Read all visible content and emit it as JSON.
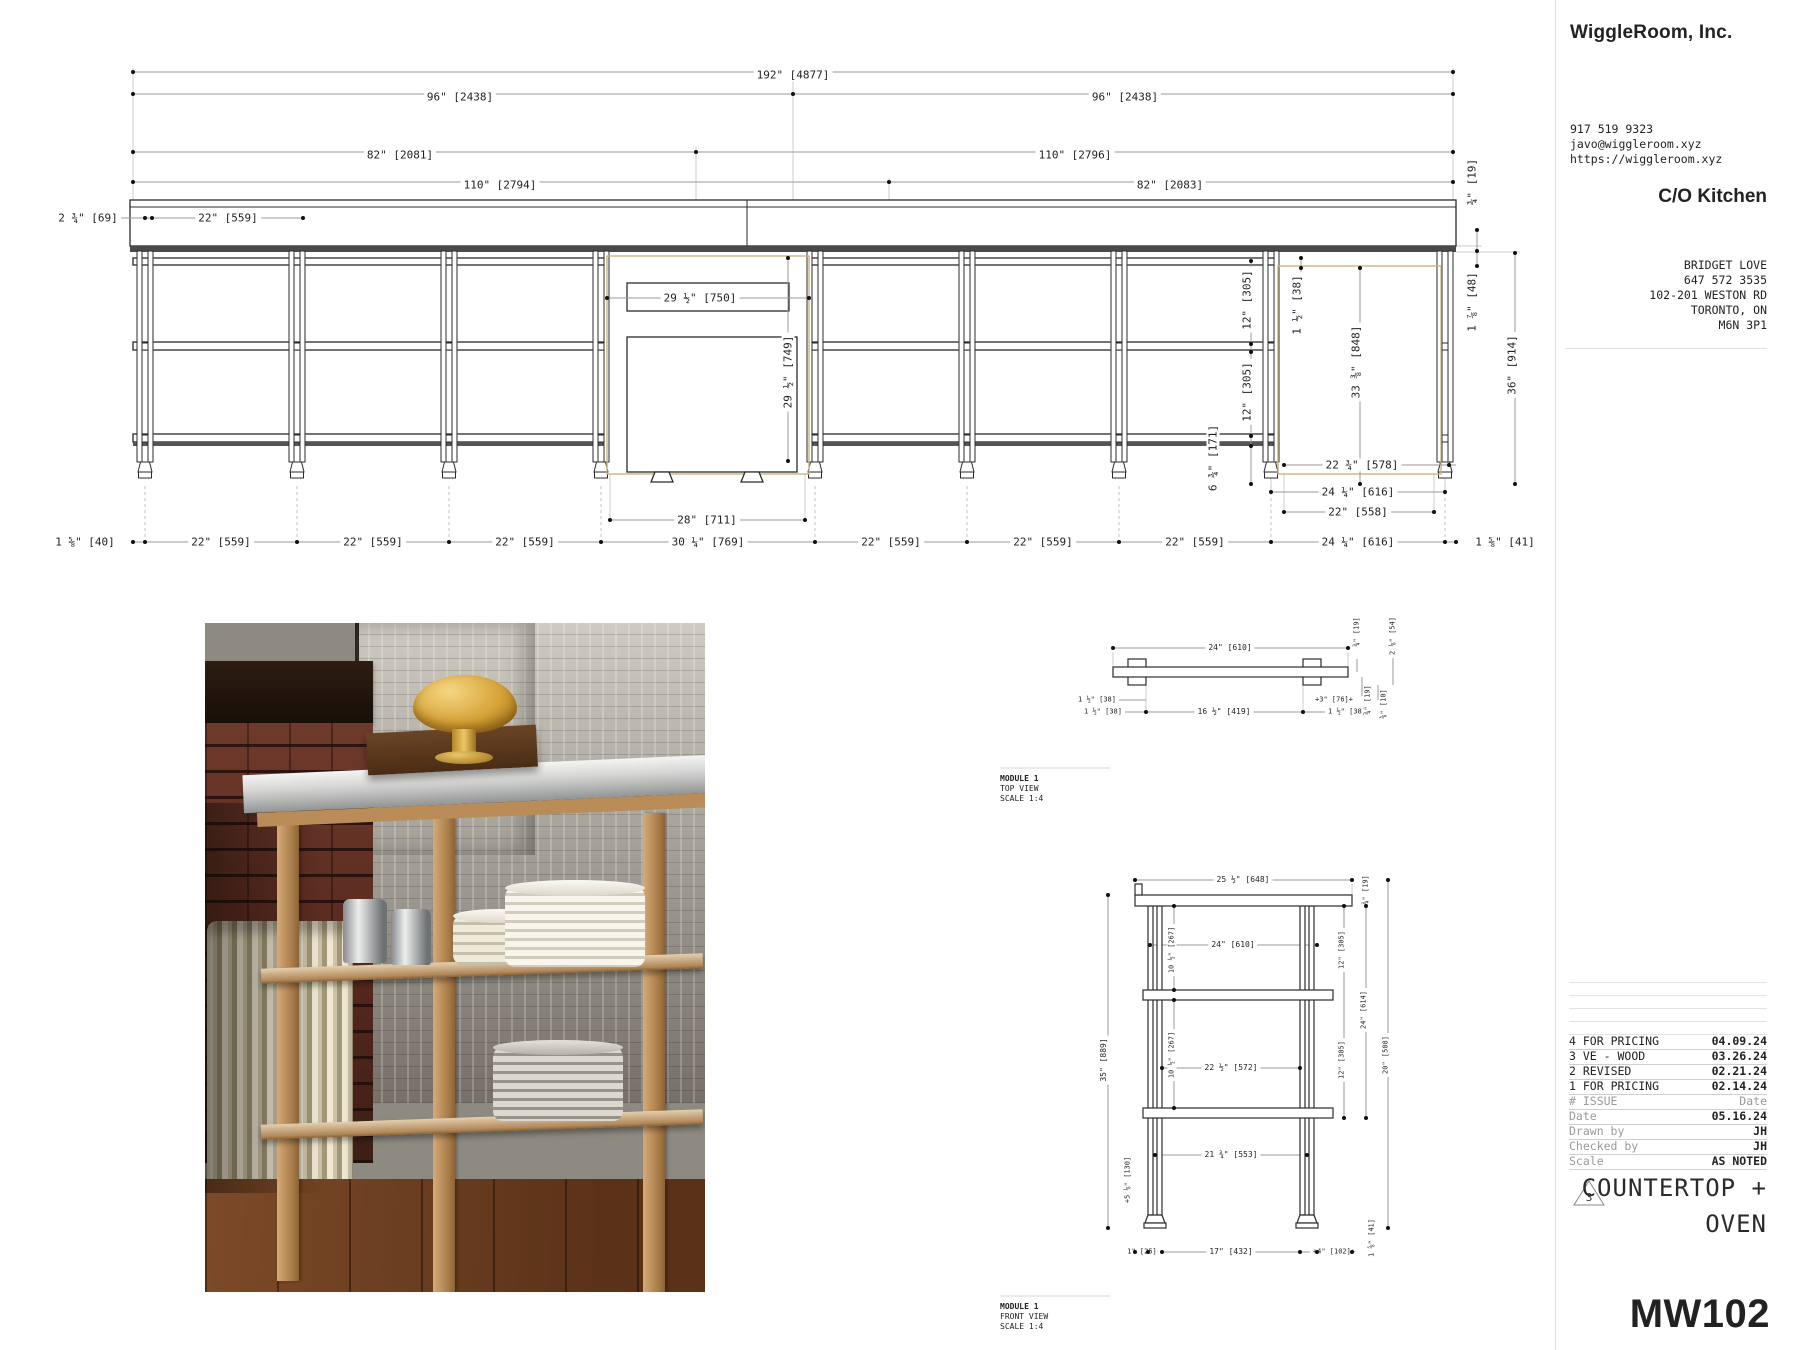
{
  "sheet": {
    "company": "WiggleRoom, Inc.",
    "contact": {
      "phone": "917 519 9323",
      "email": "javo@wiggleroom.xyz",
      "website": "https://wiggleroom.xyz"
    },
    "project": "C/O Kitchen",
    "client": {
      "name": "BRIDGET LOVE",
      "phone": "647 572 3535",
      "address": "102-201 WESTON RD",
      "city": "TORONTO, ON",
      "postal": "M6N 3P1"
    },
    "revisions": [
      {
        "num": "4",
        "label": "FOR PRICING",
        "date": "04.09.24"
      },
      {
        "num": "3",
        "label": "VE - WOOD",
        "date": "03.26.24"
      },
      {
        "num": "2",
        "label": "REVISED",
        "date": "02.21.24"
      },
      {
        "num": "1",
        "label": "FOR PRICING",
        "date": "02.14.24"
      }
    ],
    "issue": {
      "label": "# ISSUE",
      "value": "Date"
    },
    "meta": [
      {
        "label": "Date",
        "value": "05.16.24"
      },
      {
        "label": "Drawn by",
        "value": "JH"
      },
      {
        "label": "Checked by",
        "value": "JH"
      },
      {
        "label": "Scale",
        "value": "AS NOTED"
      }
    ],
    "badge": "3",
    "title_line1": "COUNTERTOP +",
    "title_line2": "OVEN",
    "code": "MW102"
  },
  "drawing": {
    "labels": [
      {
        "t": "192\" [4877]",
        "x": 793,
        "y": 75
      },
      {
        "t": "96\" [2438]",
        "x": 460,
        "y": 97
      },
      {
        "t": "96\" [2438]",
        "x": 1125,
        "y": 97
      },
      {
        "t": "82\" [2081]",
        "x": 400,
        "y": 155
      },
      {
        "t": "110\" [2796]",
        "x": 1075,
        "y": 155
      },
      {
        "t": "110\" [2794]",
        "x": 500,
        "y": 185
      },
      {
        "t": "82\" [2083]",
        "x": 1170,
        "y": 185
      },
      {
        "t": "2 ¾\" [69]",
        "x": 88,
        "y": 218
      },
      {
        "t": "22\" [559]",
        "x": 228,
        "y": 218
      },
      {
        "t": "29 ½\" [750]",
        "x": 700,
        "y": 298
      },
      {
        "t": "29 ½\" [749]",
        "x": 788,
        "y": 372,
        "r": 1
      },
      {
        "t": "28\" [711]",
        "x": 707,
        "y": 520
      },
      {
        "t": "12\" [305]",
        "x": 1247,
        "y": 300,
        "r": 1
      },
      {
        "t": "12\" [305]",
        "x": 1247,
        "y": 392,
        "r": 1
      },
      {
        "t": "6 ¾\" [171]",
        "x": 1213,
        "y": 458,
        "r": 1
      },
      {
        "t": "1 ½\" [38]",
        "x": 1297,
        "y": 305,
        "r": 1
      },
      {
        "t": "33 ⅜\" [848]",
        "x": 1356,
        "y": 362,
        "r": 1
      },
      {
        "t": "¾\" [19]",
        "x": 1472,
        "y": 182,
        "r": 1
      },
      {
        "t": "1 ⅞\" [48]",
        "x": 1472,
        "y": 302,
        "r": 1
      },
      {
        "t": "36\" [914]",
        "x": 1512,
        "y": 365,
        "r": 1
      },
      {
        "t": "22 ¾\" [578]",
        "x": 1362,
        "y": 465
      },
      {
        "t": "24 ¼\" [616]",
        "x": 1358,
        "y": 492
      },
      {
        "t": "22\" [558]",
        "x": 1358,
        "y": 512
      },
      {
        "t": "1 ⅝\" [40]",
        "x": 85,
        "y": 542
      },
      {
        "t": "22\" [559]",
        "x": 221,
        "y": 542
      },
      {
        "t": "22\" [559]",
        "x": 373,
        "y": 542
      },
      {
        "t": "22\" [559]",
        "x": 525,
        "y": 542
      },
      {
        "t": "30 ¼\" [769]",
        "x": 708,
        "y": 542
      },
      {
        "t": "22\" [559]",
        "x": 891,
        "y": 542
      },
      {
        "t": "22\" [559]",
        "x": 1043,
        "y": 542
      },
      {
        "t": "22\" [559]",
        "x": 1195,
        "y": 542
      },
      {
        "t": "24 ¼\" [616]",
        "x": 1358,
        "y": 542
      },
      {
        "t": "1 ⅝\" [41]",
        "x": 1505,
        "y": 542
      },
      {
        "t": "24\" [610]",
        "x": 1230,
        "y": 648,
        "fs": 8
      },
      {
        "t": "¾\" [19]",
        "x": 1357,
        "y": 632,
        "r": 1,
        "fs": 7
      },
      {
        "t": "2 ⅛\" [54]",
        "x": 1393,
        "y": 636,
        "r": 1,
        "fs": 7
      },
      {
        "t": "1 ½\" [38]",
        "x": 1097,
        "y": 700,
        "fs": 7
      },
      {
        "t": "1 ½\" [38]",
        "x": 1103,
        "y": 712,
        "fs": 7
      },
      {
        "t": "16 ½\" [419]",
        "x": 1224,
        "y": 712,
        "fs": 8
      },
      {
        "t": "+3\" [76]+",
        "x": 1334,
        "y": 700,
        "fs": 7
      },
      {
        "t": "1 ½\" [38]",
        "x": 1347,
        "y": 712,
        "fs": 7
      },
      {
        "t": "¾\" [19]",
        "x": 1368,
        "y": 700,
        "r": 1,
        "fs": 7
      },
      {
        "t": "⅜\" [10]",
        "x": 1384,
        "y": 704,
        "r": 1,
        "fs": 7
      },
      {
        "t": "MODULE 1",
        "x": 1000,
        "y": 779,
        "fs": 8,
        "al": "l",
        "b": 1
      },
      {
        "t": "TOP VIEW",
        "x": 1000,
        "y": 789,
        "fs": 8,
        "al": "l"
      },
      {
        "t": "SCALE 1:4",
        "x": 1000,
        "y": 799,
        "fs": 8,
        "al": "l"
      },
      {
        "t": "25 ½\" [648]",
        "x": 1243,
        "y": 880,
        "fs": 8
      },
      {
        "t": "¾\" [19]",
        "x": 1366,
        "y": 890,
        "r": 1,
        "fs": 7
      },
      {
        "t": "24\" [610]",
        "x": 1233,
        "y": 945,
        "fs": 8
      },
      {
        "t": "35\" [889]",
        "x": 1104,
        "y": 1060,
        "r": 1,
        "fs": 8
      },
      {
        "t": "10 ½\" [267]",
        "x": 1172,
        "y": 950,
        "r": 1,
        "fs": 7
      },
      {
        "t": "10 ½\" [267]",
        "x": 1172,
        "y": 1055,
        "r": 1,
        "fs": 7
      },
      {
        "t": "22 ½\" [572]",
        "x": 1231,
        "y": 1068,
        "fs": 8
      },
      {
        "t": "12\" [305]",
        "x": 1342,
        "y": 950,
        "r": 1,
        "fs": 7
      },
      {
        "t": "12\" [305]",
        "x": 1342,
        "y": 1060,
        "r": 1,
        "fs": 7
      },
      {
        "t": "24\" [614]",
        "x": 1364,
        "y": 1010,
        "r": 1,
        "fs": 7
      },
      {
        "t": "20\" [508]",
        "x": 1386,
        "y": 1055,
        "r": 1,
        "fs": 7
      },
      {
        "t": "21 ¾\" [553]",
        "x": 1231,
        "y": 1155,
        "fs": 8
      },
      {
        "t": "+5 ⅛\" [130]",
        "x": 1128,
        "y": 1180,
        "r": 1,
        "fs": 7
      },
      {
        "t": "1\" [25]",
        "x": 1142,
        "y": 1252,
        "fs": 7
      },
      {
        "t": "17\" [432]",
        "x": 1231,
        "y": 1252,
        "fs": 8
      },
      {
        "t": "+4\" [102]+",
        "x": 1334,
        "y": 1252,
        "fs": 7
      },
      {
        "t": "1 ⅝\" [41]",
        "x": 1372,
        "y": 1238,
        "r": 1,
        "fs": 7
      },
      {
        "t": "MODULE 1",
        "x": 1000,
        "y": 1307,
        "fs": 8,
        "al": "l",
        "b": 1
      },
      {
        "t": "FRONT VIEW",
        "x": 1000,
        "y": 1317,
        "fs": 8,
        "al": "l"
      },
      {
        "t": "SCALE 1:4",
        "x": 1000,
        "y": 1327,
        "fs": 8,
        "al": "l"
      }
    ],
    "dots": [
      [
        133,
        72
      ],
      [
        1453,
        72
      ],
      [
        133,
        94
      ],
      [
        793,
        94
      ],
      [
        1453,
        94
      ],
      [
        133,
        152
      ],
      [
        696,
        152
      ],
      [
        1453,
        152
      ],
      [
        133,
        182
      ],
      [
        889,
        182
      ],
      [
        1453,
        182
      ],
      [
        145,
        218
      ],
      [
        152,
        218
      ],
      [
        303,
        218
      ],
      [
        607,
        298
      ],
      [
        809,
        298
      ],
      [
        788,
        258
      ],
      [
        788,
        461
      ],
      [
        610,
        520
      ],
      [
        805,
        520
      ],
      [
        1251,
        261
      ],
      [
        1251,
        344
      ],
      [
        1251,
        352
      ],
      [
        1251,
        436
      ],
      [
        1251,
        446
      ],
      [
        1251,
        484
      ],
      [
        1301,
        258
      ],
      [
        1301,
        268
      ],
      [
        1360,
        268
      ],
      [
        1360,
        484
      ],
      [
        1477,
        230
      ],
      [
        1477,
        251
      ],
      [
        1477,
        266
      ],
      [
        1515,
        253
      ],
      [
        1515,
        484
      ],
      [
        1284,
        465
      ],
      [
        1449,
        465
      ],
      [
        1271,
        492
      ],
      [
        1445,
        492
      ],
      [
        1284,
        512
      ],
      [
        1434,
        512
      ],
      [
        133,
        542
      ],
      [
        145,
        542
      ],
      [
        297,
        542
      ],
      [
        449,
        542
      ],
      [
        601,
        542
      ],
      [
        815,
        542
      ],
      [
        967,
        542
      ],
      [
        1119,
        542
      ],
      [
        1271,
        542
      ],
      [
        1445,
        542
      ],
      [
        1456,
        542
      ],
      [
        1113,
        648
      ],
      [
        1348,
        648
      ],
      [
        1146,
        712
      ],
      [
        1303,
        712
      ],
      [
        1135,
        880
      ],
      [
        1352,
        880
      ],
      [
        1150,
        945
      ],
      [
        1317,
        945
      ],
      [
        1108,
        895
      ],
      [
        1108,
        1228
      ],
      [
        1174,
        906
      ],
      [
        1174,
        990
      ],
      [
        1174,
        1000
      ],
      [
        1174,
        1108
      ],
      [
        1162,
        1068
      ],
      [
        1300,
        1068
      ],
      [
        1344,
        906
      ],
      [
        1344,
        1118
      ],
      [
        1366,
        906
      ],
      [
        1366,
        1118
      ],
      [
        1388,
        880
      ],
      [
        1388,
        1228
      ],
      [
        1155,
        1155
      ],
      [
        1307,
        1155
      ],
      [
        1135,
        1252
      ],
      [
        1148,
        1252
      ],
      [
        1162,
        1252
      ],
      [
        1300,
        1252
      ],
      [
        1317,
        1252
      ],
      [
        1352,
        1252
      ]
    ]
  }
}
